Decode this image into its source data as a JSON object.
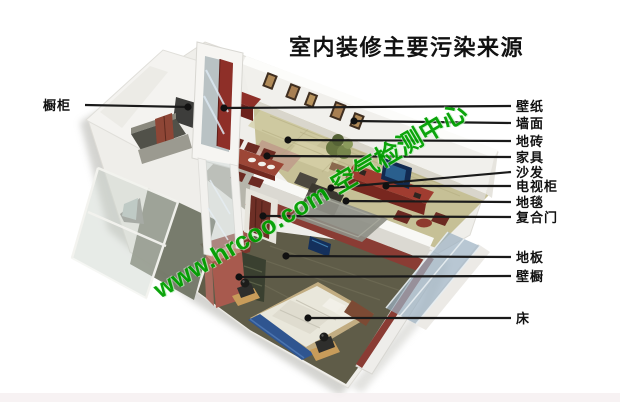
{
  "title": {
    "text": "室内装修主要污染来源"
  },
  "watermark": {
    "text": "www.hrcoo.com 空气检测中心",
    "color": "#00a000"
  },
  "colors": {
    "leader_line": "#1a1a1a",
    "label_text": "#111111",
    "title_text": "#121212",
    "watermark_green": "#00a000",
    "maroon_furniture": "#8e3a30",
    "living_floor_tan": "#c6c096",
    "bedroom_floor_olive": "#5f5c48",
    "bed_white": "#e9e7db",
    "bench_blue": "#2f5590"
  },
  "annotations": [
    {
      "id": "cupboard",
      "text": "橱柜",
      "side": "left",
      "label": {
        "x": 43,
        "y": 105
      },
      "line_start": {
        "x": 85,
        "y": 105
      },
      "dot": {
        "x": 188,
        "y": 107
      }
    },
    {
      "id": "wallpaper",
      "text": "壁纸",
      "side": "right",
      "label": {
        "x": 516,
        "y": 106
      },
      "dot": {
        "x": 224,
        "y": 108
      }
    },
    {
      "id": "wall-surface",
      "text": "墙面",
      "side": "right",
      "label": {
        "x": 516,
        "y": 123
      },
      "dot": {
        "x": 354,
        "y": 121
      }
    },
    {
      "id": "floor-tile",
      "text": "地砖",
      "side": "right",
      "label": {
        "x": 516,
        "y": 141
      },
      "dot": {
        "x": 288,
        "y": 140
      }
    },
    {
      "id": "furniture",
      "text": "家具",
      "side": "right",
      "label": {
        "x": 516,
        "y": 157
      },
      "dot": {
        "x": 267,
        "y": 156
      }
    },
    {
      "id": "sofa",
      "text": "沙发",
      "side": "right",
      "label": {
        "x": 516,
        "y": 172
      },
      "dot": {
        "x": 331,
        "y": 188
      }
    },
    {
      "id": "tv-cabinet",
      "text": "电视柜",
      "side": "right",
      "label": {
        "x": 516,
        "y": 186
      },
      "dot": {
        "x": 386,
        "y": 186
      }
    },
    {
      "id": "carpet",
      "text": "地毯",
      "side": "right",
      "label": {
        "x": 516,
        "y": 202
      },
      "dot": {
        "x": 346,
        "y": 201
      }
    },
    {
      "id": "composite-door",
      "text": "复合门",
      "side": "right",
      "label": {
        "x": 516,
        "y": 217
      },
      "dot": {
        "x": 263,
        "y": 216
      }
    },
    {
      "id": "wood-floor",
      "text": "地板",
      "side": "right",
      "label": {
        "x": 516,
        "y": 257
      },
      "dot": {
        "x": 286,
        "y": 256
      }
    },
    {
      "id": "closet",
      "text": "壁橱",
      "side": "right",
      "label": {
        "x": 516,
        "y": 276
      },
      "dot": {
        "x": 239,
        "y": 277
      }
    },
    {
      "id": "bed",
      "text": "床",
      "side": "right",
      "label": {
        "x": 516,
        "y": 318
      },
      "dot": {
        "x": 308,
        "y": 318
      }
    }
  ]
}
